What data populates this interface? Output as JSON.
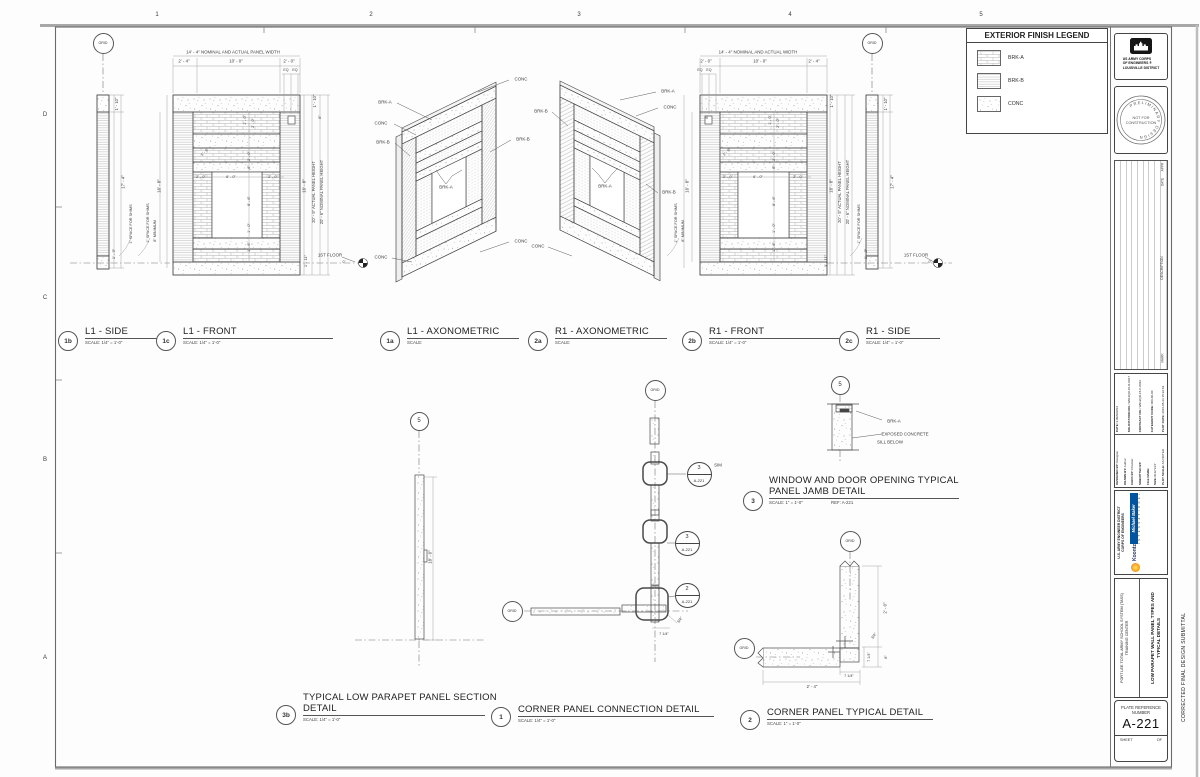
{
  "sheet": {
    "grid_cols": [
      "1",
      "2",
      "3",
      "4",
      "5"
    ],
    "grid_rows": [
      "D",
      "C",
      "B",
      "A"
    ],
    "side_note": "CORRECTED FINAL DESIGN SUBMITTAL"
  },
  "legend": {
    "title": "EXTERIOR FINISH LEGEND",
    "items": [
      {
        "label": "BRK-A",
        "pattern": "brkA"
      },
      {
        "label": "BRK-B",
        "pattern": "brkB"
      },
      {
        "label": "CONC",
        "pattern": "conc"
      }
    ]
  },
  "titleblock": {
    "agency_lines": [
      "US ARMY CORPS",
      "OF ENGINEERS ®",
      "LOUISVILLE DISTRICT"
    ],
    "stamp_ring": "PRELIMINARY  DESIGN",
    "stamp_center1": "NOT FOR",
    "stamp_center2": "CONSTRUCTION",
    "rev_headers": {
      "appr": "APPR",
      "date": "DATE",
      "description": "DESCRIPTION",
      "mark": "MARK"
    },
    "fields_left": [
      {
        "l": "DESIGNED BY:",
        "v": "Designer"
      },
      {
        "l": "DRAWN BY:",
        "v": "Author"
      },
      {
        "l": "CHKD BY:",
        "v": "Checker"
      },
      {
        "l": "SUBMITTED BY:",
        "v": ""
      },
      {
        "l": "FILE NAME:",
        "v": ""
      },
      {
        "l": "SIZE: D",
        "v": "22\"x34\""
      },
      {
        "l": "PLOT SCALE:",
        "v": "AS NOTED"
      }
    ],
    "fields_right": [
      {
        "l": "DATE:",
        "v": "31MAR2016"
      },
      {
        "l": "SOLICITATION NO.:",
        "v": "W912QR-15-R-0017"
      },
      {
        "l": "CONTRACT NO.:",
        "v": "W912QR-15-C-0042"
      },
      {
        "l": "CATEGORY CODE:",
        "v": "000-00-00"
      },
      {
        "l": "PLOT DATE:",
        "v": "2016-05-23 15:22:19"
      }
    ],
    "district_line1": "U.S. ARMY ENGINEER DISTRICT",
    "district_line2": "CORPS OF ENGINEERS",
    "firm_name": "Michael Baker",
    "firm_sub": "I N T E R N A T I O N A L",
    "partner_name": "Koontz",
    "project_line1": "FORT LEE TOTAL ARMY SCHOOL SYSTEM (TASS)",
    "project_line2": "TRAINING CENTER",
    "sheet_title1": "LOW PARAPET WALL PANEL TYPES AND",
    "sheet_title2": "TYPICAL DETAILS",
    "plate_ref_label": "PLATE REFERENCE",
    "number_label": "NUMBER",
    "plate_number": "A-221",
    "sheet_label": "SHEET",
    "of_label": "OF"
  },
  "views": [
    {
      "num": "1b",
      "title": "L1 - SIDE",
      "scale": "SCALE: 1/4\" = 1'-0\"",
      "bx": 68,
      "by": 341,
      "tx": 85,
      "ty": 326,
      "ul": 78
    },
    {
      "num": "1c",
      "title": "L1 - FRONT",
      "scale": "SCALE: 1/4\" = 1'-0\"",
      "bx": 166,
      "by": 341,
      "tx": 183,
      "ty": 326,
      "ul": 150
    },
    {
      "num": "1a",
      "title": "L1 - AXONOMETRIC",
      "scale": "SCALE:",
      "bx": 390,
      "by": 341,
      "tx": 407,
      "ty": 326,
      "ul": 112
    },
    {
      "num": "2a",
      "title": "R1 - AXONOMETRIC",
      "scale": "SCALE:",
      "bx": 538,
      "by": 341,
      "tx": 555,
      "ty": 326,
      "ul": 112
    },
    {
      "num": "2b",
      "title": "R1 - FRONT",
      "scale": "SCALE: 1/4\" = 1'-0\"",
      "bx": 692,
      "by": 341,
      "tx": 709,
      "ty": 326,
      "ul": 132
    },
    {
      "num": "2c",
      "title": "R1 - SIDE",
      "scale": "SCALE: 1/4\" = 1'-0\"",
      "bx": 849,
      "by": 341,
      "tx": 866,
      "ty": 326,
      "ul": 74
    },
    {
      "num": "3b",
      "title": "TYPICAL LOW PARAPET PANEL SECTION",
      "title2": "DETAIL",
      "scale": "SCALE: 1/4\" = 1'-0\"",
      "bx": 286,
      "by": 715,
      "tx": 303,
      "ty": 692,
      "ul": 182
    },
    {
      "num": "1",
      "title": "CORNER PANEL CONNECTION DETAIL",
      "scale": "SCALE: 1/4\" = 1'-0\"",
      "bx": 501,
      "by": 717,
      "tx": 518,
      "ty": 704,
      "ul": 196
    },
    {
      "num": "2",
      "title": "CORNER PANEL TYPICAL DETAIL",
      "scale": "SCALE: 1\" = 1'-0\"",
      "bx": 750,
      "by": 720,
      "tx": 767,
      "ty": 707,
      "ul": 166
    },
    {
      "num": "3",
      "title": "WINDOW AND DOOR OPENING TYPICAL",
      "title2": "PANEL JAMB DETAIL",
      "scale": "SCALE: 1\" = 1'-0\"",
      "ref": "REF:  A-221",
      "bx": 753,
      "by": 501,
      "tx": 769,
      "ty": 475,
      "ul": 190
    }
  ],
  "bubbles": [
    {
      "t": "GRID",
      "x": 103,
      "y": 43,
      "d": 21,
      "fs": 3.6
    },
    {
      "t": "GRID",
      "x": 872,
      "y": 43,
      "d": 21,
      "fs": 3.6
    },
    {
      "t": "5",
      "x": 419,
      "y": 421,
      "d": 19,
      "fs": 6
    },
    {
      "t": "GRID",
      "x": 655,
      "y": 390,
      "d": 21,
      "fs": 3.6
    },
    {
      "t": "GRID",
      "x": 512,
      "y": 611,
      "d": 21,
      "fs": 3.6
    },
    {
      "t": "GRID",
      "x": 850,
      "y": 541,
      "d": 21,
      "fs": 3.6
    },
    {
      "t": "GRID",
      "x": 744,
      "y": 648,
      "d": 21,
      "fs": 3.6
    },
    {
      "t": "5",
      "x": 840,
      "y": 385,
      "d": 19,
      "fs": 6
    }
  ],
  "callouts": [
    {
      "top": "3",
      "bot": "A-221",
      "x": 699,
      "y": 474
    },
    {
      "top": "3",
      "bot": "A-221",
      "x": 687,
      "y": 543
    },
    {
      "top": "2",
      "bot": "A-221",
      "x": 687,
      "y": 595
    }
  ],
  "annotations": [
    {
      "t": "1",
      "x": 157,
      "y": 15,
      "s": 6,
      "n": "grid-col-label"
    },
    {
      "t": "2",
      "x": 371,
      "y": 15,
      "s": 6,
      "n": "grid-col-label"
    },
    {
      "t": "3",
      "x": 579,
      "y": 15,
      "s": 6,
      "n": "grid-col-label"
    },
    {
      "t": "4",
      "x": 790,
      "y": 15,
      "s": 6,
      "n": "grid-col-label"
    },
    {
      "t": "5",
      "x": 981,
      "y": 15,
      "s": 6,
      "n": "grid-col-label"
    },
    {
      "t": "D",
      "x": 45,
      "y": 115,
      "s": 6,
      "n": "grid-row-label"
    },
    {
      "t": "C",
      "x": 45,
      "y": 298,
      "s": 6,
      "n": "grid-row-label"
    },
    {
      "t": "B",
      "x": 45,
      "y": 460,
      "s": 6,
      "n": "grid-row-label"
    },
    {
      "t": "A",
      "x": 45,
      "y": 658,
      "s": 6,
      "n": "grid-row-label"
    },
    {
      "t": "14' - 4\" NOMINAL AND ACTUAL PANEL WIDTH",
      "x": 233,
      "y": 53,
      "s": 4.4
    },
    {
      "t": "2' - 4\"",
      "x": 184,
      "y": 62,
      "s": 4.4
    },
    {
      "t": "10' - 0\"",
      "x": 236,
      "y": 62,
      "s": 4.4
    },
    {
      "t": "2' - 0\"",
      "x": 289,
      "y": 62,
      "s": 4.4
    },
    {
      "t": "EQ",
      "x": 286,
      "y": 71,
      "s": 3.6
    },
    {
      "t": "EQ",
      "x": 295,
      "y": 71,
      "s": 3.6
    },
    {
      "t": "1' - 10\"",
      "x": 117,
      "y": 104,
      "r": -90,
      "s": 4.2
    },
    {
      "t": "17' - 4\"",
      "x": 124,
      "y": 182,
      "r": -90,
      "s": 4.4
    },
    {
      "t": "1' - 3\"",
      "x": 114,
      "y": 254,
      "r": -90,
      "s": 4
    },
    {
      "t": "1\" SPACE FOR SHIMS",
      "x": 131,
      "y": 224,
      "r": -90,
      "s": 3.8
    },
    {
      "t": "16' - 8\"",
      "x": 160,
      "y": 186,
      "r": -90,
      "s": 4.4
    },
    {
      "t": "1\" SPACE FOR SHIMS",
      "x": 148,
      "y": 223,
      "r": -90,
      "s": 3.8
    },
    {
      "t": "8\" MINIMUM",
      "x": 155,
      "y": 231,
      "r": -90,
      "s": 3.8
    },
    {
      "t": "1' - 10\"",
      "x": 315,
      "y": 101,
      "r": -90,
      "s": 4.2
    },
    {
      "t": "8\"",
      "x": 320,
      "y": 117,
      "r": -90,
      "s": 3.8
    },
    {
      "t": "16' - 8\"",
      "x": 305,
      "y": 186,
      "r": -90,
      "s": 4.4
    },
    {
      "t": "20' - 5\" ACTUAL PANEL HEIGHT",
      "x": 314,
      "y": 192,
      "r": -90,
      "s": 4.2
    },
    {
      "t": "20' - 6\" NOMINAL PANEL HEIGHT",
      "x": 322,
      "y": 192,
      "r": -90,
      "s": 4.2
    },
    {
      "t": "1' - 11\"",
      "x": 306,
      "y": 261,
      "r": -90,
      "s": 4
    },
    {
      "t": "1' - 0\"",
      "x": 245,
      "y": 120,
      "r": -90,
      "s": 3.8
    },
    {
      "t": "2' - 0\"",
      "x": 253,
      "y": 123,
      "r": -90,
      "s": 3.8
    },
    {
      "t": "2' - 0\"",
      "x": 249,
      "y": 156,
      "r": -90,
      "s": 3.8
    },
    {
      "t": "1' - 6\"",
      "x": 205,
      "y": 152,
      "r": -45,
      "s": 3.8
    },
    {
      "t": "8\"",
      "x": 249,
      "y": 167,
      "r": -90,
      "s": 3.8
    },
    {
      "t": "2' - 0\"",
      "x": 201,
      "y": 177,
      "s": 3.8
    },
    {
      "t": "6' - 0\"",
      "x": 231,
      "y": 177,
      "s": 3.8
    },
    {
      "t": "2' - 0\"",
      "x": 273,
      "y": 177,
      "s": 3.8
    },
    {
      "t": "8' - 6\"",
      "x": 249,
      "y": 201,
      "r": -90,
      "s": 3.8
    },
    {
      "t": "1' - 0\"",
      "x": 249,
      "y": 228,
      "r": -90,
      "s": 3.8
    },
    {
      "t": "1' - 6\"",
      "x": 249,
      "y": 247,
      "r": -90,
      "s": 3.8
    },
    {
      "t": "1ST FLOOR",
      "x": 330,
      "y": 256,
      "s": 4.4
    },
    {
      "t": "0\"",
      "x": 344,
      "y": 263,
      "s": 3.4
    },
    {
      "t": "14' - 4\" NOMINAL AND ACTUAL WIDTH",
      "x": 758,
      "y": 53,
      "s": 4.4
    },
    {
      "t": "2' - 0\"",
      "x": 706,
      "y": 62,
      "s": 4.4
    },
    {
      "t": "10' - 0\"",
      "x": 760,
      "y": 62,
      "s": 4.4
    },
    {
      "t": "2' - 4\"",
      "x": 814,
      "y": 62,
      "s": 4.4
    },
    {
      "t": "EQ",
      "x": 700,
      "y": 71,
      "s": 3.6
    },
    {
      "t": "EQ",
      "x": 709,
      "y": 71,
      "s": 3.6
    },
    {
      "t": "8\"",
      "x": 707,
      "y": 117,
      "r": -90,
      "s": 3.8
    },
    {
      "t": "16' - 8\"",
      "x": 688,
      "y": 186,
      "r": -90,
      "s": 4.4
    },
    {
      "t": "1\" SPACE FOR SHIMS",
      "x": 676,
      "y": 223,
      "r": -90,
      "s": 3.8
    },
    {
      "t": "8\" MINIMUM",
      "x": 683,
      "y": 231,
      "r": -90,
      "s": 3.8
    },
    {
      "t": "1' - 10\"",
      "x": 832,
      "y": 101,
      "r": -90,
      "s": 4.2
    },
    {
      "t": "16' - 8\"",
      "x": 832,
      "y": 186,
      "r": -90,
      "s": 4.4
    },
    {
      "t": "20' - 5\" ACTUAL PANEL HEIGHT",
      "x": 840,
      "y": 192,
      "r": -90,
      "s": 4.2
    },
    {
      "t": "20' - 6\" NOMINAL PANEL HEIGHT",
      "x": 848,
      "y": 192,
      "r": -90,
      "s": 4.2
    },
    {
      "t": "1' - 11\"",
      "x": 826,
      "y": 261,
      "r": -90,
      "s": 4
    },
    {
      "t": "1' - 0\"",
      "x": 770,
      "y": 120,
      "r": -90,
      "s": 3.8
    },
    {
      "t": "2' - 0\"",
      "x": 778,
      "y": 123,
      "r": -90,
      "s": 3.8
    },
    {
      "t": "2' - 0\"",
      "x": 774,
      "y": 156,
      "r": -90,
      "s": 3.8
    },
    {
      "t": "1' - 6\"",
      "x": 727,
      "y": 152,
      "r": -45,
      "s": 3.8
    },
    {
      "t": "8\"",
      "x": 774,
      "y": 167,
      "r": -90,
      "s": 3.8
    },
    {
      "t": "2' - 0\"",
      "x": 728,
      "y": 177,
      "s": 3.8
    },
    {
      "t": "6' - 0\"",
      "x": 758,
      "y": 177,
      "s": 3.8
    },
    {
      "t": "2' - 0\"",
      "x": 798,
      "y": 177,
      "s": 3.8
    },
    {
      "t": "8' - 6\"",
      "x": 774,
      "y": 201,
      "r": -90,
      "s": 3.8
    },
    {
      "t": "1' - 0\"",
      "x": 774,
      "y": 228,
      "r": -90,
      "s": 3.8
    },
    {
      "t": "1' - 6\"",
      "x": 774,
      "y": 247,
      "r": -90,
      "s": 3.8
    },
    {
      "t": "1\" SPACE FOR SHIMS",
      "x": 859,
      "y": 224,
      "r": -90,
      "s": 3.8
    },
    {
      "t": "1' - 3\"",
      "x": 866,
      "y": 254,
      "r": -90,
      "s": 4
    },
    {
      "t": "1' - 10\"",
      "x": 886,
      "y": 104,
      "r": -90,
      "s": 4.2
    },
    {
      "t": "17' - 4\"",
      "x": 893,
      "y": 182,
      "r": -90,
      "s": 4.4
    },
    {
      "t": "1ST FLOOR",
      "x": 916,
      "y": 256,
      "s": 4.4
    },
    {
      "t": "0\"",
      "x": 930,
      "y": 263,
      "s": 3.4
    },
    {
      "t": "BRK-A",
      "x": 385,
      "y": 103,
      "s": 4.4,
      "n": "finish-label"
    },
    {
      "t": "CONC",
      "x": 381,
      "y": 124,
      "s": 4.4,
      "n": "finish-label"
    },
    {
      "t": "BRK-B",
      "x": 383,
      "y": 143,
      "s": 4.4,
      "n": "finish-label"
    },
    {
      "t": "BRK-A",
      "x": 446,
      "y": 188,
      "s": 4.4,
      "n": "finish-label"
    },
    {
      "t": "CONC",
      "x": 521,
      "y": 80,
      "s": 4.4,
      "n": "finish-label"
    },
    {
      "t": "BRK-B",
      "x": 523,
      "y": 140,
      "s": 4.4,
      "n": "finish-label"
    },
    {
      "t": "CONC",
      "x": 521,
      "y": 242,
      "s": 4.4,
      "n": "finish-label"
    },
    {
      "t": "CONC",
      "x": 381,
      "y": 258,
      "s": 4.4,
      "n": "finish-label"
    },
    {
      "t": "BRK-B",
      "x": 541,
      "y": 112,
      "s": 4.4,
      "n": "finish-label"
    },
    {
      "t": "BRK-A",
      "x": 668,
      "y": 92,
      "s": 4.4,
      "n": "finish-label"
    },
    {
      "t": "CONC",
      "x": 670,
      "y": 108,
      "s": 4.4,
      "n": "finish-label"
    },
    {
      "t": "BRK-A",
      "x": 605,
      "y": 187,
      "s": 4.4,
      "n": "finish-label"
    },
    {
      "t": "BRK-B",
      "x": 669,
      "y": 193,
      "s": 4.4,
      "n": "finish-label"
    },
    {
      "t": "CONC",
      "x": 538,
      "y": 247,
      "s": 4.4,
      "n": "finish-label"
    },
    {
      "t": "18' - 0\"",
      "x": 431,
      "y": 557,
      "r": -90,
      "s": 4.4
    },
    {
      "t": "SIM",
      "x": 718,
      "y": 466,
      "s": 4.4
    },
    {
      "t": "3/4\"",
      "x": 680,
      "y": 620,
      "r": -55,
      "s": 3.8
    },
    {
      "t": "7 1/4\"",
      "x": 664,
      "y": 634,
      "s": 3.8
    },
    {
      "t": "2' - 0\"",
      "x": 886,
      "y": 608,
      "r": -90,
      "s": 4.4
    },
    {
      "t": "3/4\"",
      "x": 874,
      "y": 636,
      "r": -55,
      "s": 3.8
    },
    {
      "t": "8\"",
      "x": 886,
      "y": 657,
      "r": -90,
      "s": 3.8
    },
    {
      "t": "7 1/4\"",
      "x": 869,
      "y": 657,
      "r": -90,
      "s": 3.8
    },
    {
      "t": "7 1/4\"",
      "x": 849,
      "y": 676,
      "s": 3.8
    },
    {
      "t": "2' - 4\"",
      "x": 812,
      "y": 687,
      "s": 4.2
    },
    {
      "t": "BRK-A",
      "x": 894,
      "y": 422,
      "s": 4.4,
      "n": "finish-label"
    },
    {
      "t": "EXPOSED CONCRETE",
      "x": 905,
      "y": 435,
      "s": 4.4
    },
    {
      "t": "SILL BELOW",
      "x": 890,
      "y": 443,
      "s": 4.4
    },
    {
      "t": "APPR",
      "x": 1163,
      "y": 167,
      "r": -90,
      "s": 3.2,
      "n": "rev-header"
    },
    {
      "t": "DATE",
      "x": 1163,
      "y": 182,
      "r": -90,
      "s": 3.2,
      "n": "rev-header"
    },
    {
      "t": "DESCRIPTION",
      "x": 1163,
      "y": 268,
      "r": -90,
      "s": 3.4,
      "n": "rev-header"
    },
    {
      "t": "MARK",
      "x": 1163,
      "y": 358,
      "r": -90,
      "s": 3.2,
      "n": "rev-header"
    }
  ]
}
